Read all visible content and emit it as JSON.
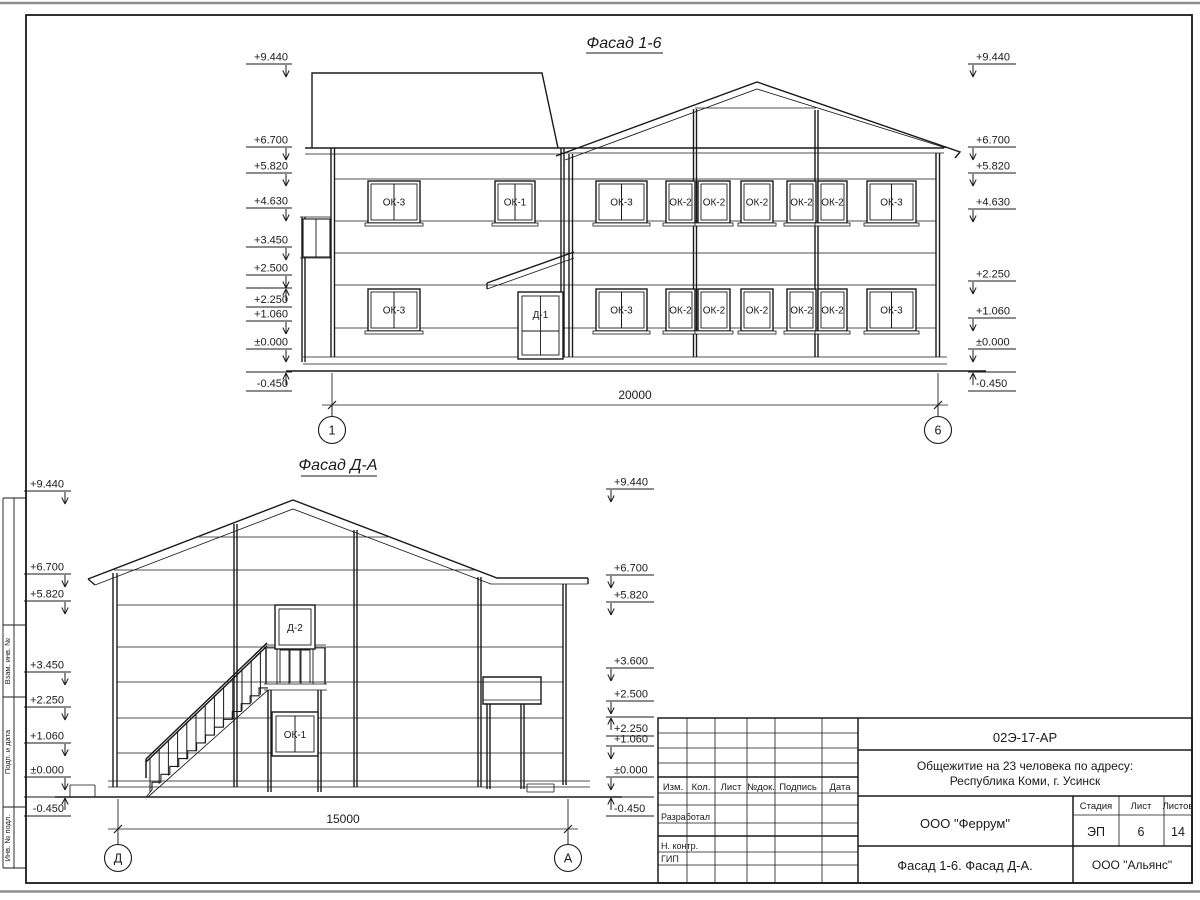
{
  "sheet": {
    "drawing_code": "02Э-17-АР",
    "project_title_line1": "Общежитие на 23 человека по адресу:",
    "project_title_line2": "Республика Коми, г. Усинск",
    "sheet_title": "Фасад 1-6. Фасад Д-А.",
    "designer_org": "ООО \"Феррум\"",
    "contractor_org": "ООО \"Альянс\"",
    "stage_label": "Стадия",
    "stage_value": "ЭП",
    "sheet_label": "Лист",
    "sheet_value": "6",
    "sheets_label": "Листов",
    "sheets_value": "14",
    "header_cols": [
      "Изм.",
      "Кол.",
      "Лист",
      "№док.",
      "Подпись",
      "Дата"
    ],
    "role_rows": [
      "Разработал",
      "Н. контр.",
      "ГИП"
    ],
    "side_stamp": [
      "Взам. инв. №",
      "Подп. и дата",
      "Инв. № подл."
    ]
  },
  "facade1": {
    "title": "Фасад 1-6",
    "dimension": "20000",
    "axis_left": "1",
    "axis_right": "6",
    "door_label": "Д-1",
    "windows_upper": [
      {
        "label": "ОК-3",
        "x": 368,
        "w": 52,
        "panes": 2
      },
      {
        "label": "ОК-1",
        "x": 495,
        "w": 40,
        "panes": 2
      },
      {
        "label": "ОК-3",
        "x": 596,
        "w": 51,
        "panes": 2
      },
      {
        "label": "ОК-2",
        "x": 666,
        "w": 29,
        "panes": 1
      },
      {
        "label": "ОК-2",
        "x": 698,
        "w": 32,
        "panes": 1
      },
      {
        "label": "ОК-2",
        "x": 741,
        "w": 32,
        "panes": 1
      },
      {
        "label": "ОК-2",
        "x": 787,
        "w": 29,
        "panes": 1
      },
      {
        "label": "ОК-2",
        "x": 818,
        "w": 29,
        "panes": 1
      },
      {
        "label": "ОК-3",
        "x": 867,
        "w": 49,
        "panes": 2
      }
    ],
    "windows_lower": [
      {
        "label": "ОК-3",
        "x": 368,
        "w": 52,
        "panes": 2
      },
      {
        "label": "ОК-3",
        "x": 596,
        "w": 51,
        "panes": 2
      },
      {
        "label": "ОК-2",
        "x": 666,
        "w": 29,
        "panes": 1
      },
      {
        "label": "ОК-2",
        "x": 698,
        "w": 32,
        "panes": 1
      },
      {
        "label": "ОК-2",
        "x": 741,
        "w": 32,
        "panes": 1
      },
      {
        "label": "ОК-2",
        "x": 787,
        "w": 29,
        "panes": 1
      },
      {
        "label": "ОК-2",
        "x": 818,
        "w": 29,
        "panes": 1
      },
      {
        "label": "ОК-3",
        "x": 867,
        "w": 49,
        "panes": 2
      }
    ],
    "marks_left": [
      {
        "label": "+9.440",
        "y": 64,
        "dir": "down"
      },
      {
        "label": "+6.700",
        "y": 147,
        "dir": "down"
      },
      {
        "label": "+5.820",
        "y": 173,
        "dir": "down"
      },
      {
        "label": "+4.630",
        "y": 208,
        "dir": "down"
      },
      {
        "label": "+3.450",
        "y": 247,
        "dir": "down"
      },
      {
        "label": "+2.500",
        "y": 275,
        "dir": "down"
      },
      {
        "label": "+2.250",
        "y": 288,
        "dir": "up"
      },
      {
        "label": "+1.060",
        "y": 321,
        "dir": "down"
      },
      {
        "label": "±0.000",
        "y": 349,
        "dir": "down"
      },
      {
        "label": "-0.450",
        "y": 372,
        "dir": "up"
      }
    ],
    "marks_right": [
      {
        "label": "+9.440",
        "y": 64,
        "dir": "down"
      },
      {
        "label": "+6.700",
        "y": 147,
        "dir": "down"
      },
      {
        "label": "+5.820",
        "y": 173,
        "dir": "down"
      },
      {
        "label": "+4.630",
        "y": 209,
        "dir": "down"
      },
      {
        "label": "+2.250",
        "y": 281,
        "dir": "down"
      },
      {
        "label": "+1.060",
        "y": 318,
        "dir": "down"
      },
      {
        "label": "±0.000",
        "y": 349,
        "dir": "down"
      },
      {
        "label": "-0.450",
        "y": 372,
        "dir": "up"
      }
    ]
  },
  "facade2": {
    "title": "Фасад Д-А",
    "dimension": "15000",
    "axis_left": "Д",
    "axis_right": "А",
    "door_label": "Д-2",
    "window_label": "ОК-1",
    "marks_left": [
      {
        "label": "+9.440",
        "y": 491,
        "dir": "down"
      },
      {
        "label": "+6.700",
        "y": 574,
        "dir": "down"
      },
      {
        "label": "+5.820",
        "y": 601,
        "dir": "down"
      },
      {
        "label": "+3.450",
        "y": 672,
        "dir": "down"
      },
      {
        "label": "+2.250",
        "y": 707,
        "dir": "down"
      },
      {
        "label": "+1.060",
        "y": 743,
        "dir": "down"
      },
      {
        "label": "±0.000",
        "y": 777,
        "dir": "down"
      },
      {
        "label": "-0.450",
        "y": 797,
        "dir": "up"
      }
    ],
    "marks_right": [
      {
        "label": "+9.440",
        "y": 489,
        "dir": "down"
      },
      {
        "label": "+6.700",
        "y": 575,
        "dir": "down"
      },
      {
        "label": "+5.820",
        "y": 602,
        "dir": "down"
      },
      {
        "label": "+3.600",
        "y": 668,
        "dir": "down"
      },
      {
        "label": "+2.500",
        "y": 701,
        "dir": "down"
      },
      {
        "label": "+2.250",
        "y": 717,
        "dir": "up"
      },
      {
        "label": "+1.060",
        "y": 746,
        "dir": "down"
      },
      {
        "label": "±0.000",
        "y": 777,
        "dir": "down"
      },
      {
        "label": "-0.450",
        "y": 797,
        "dir": "up"
      }
    ]
  }
}
